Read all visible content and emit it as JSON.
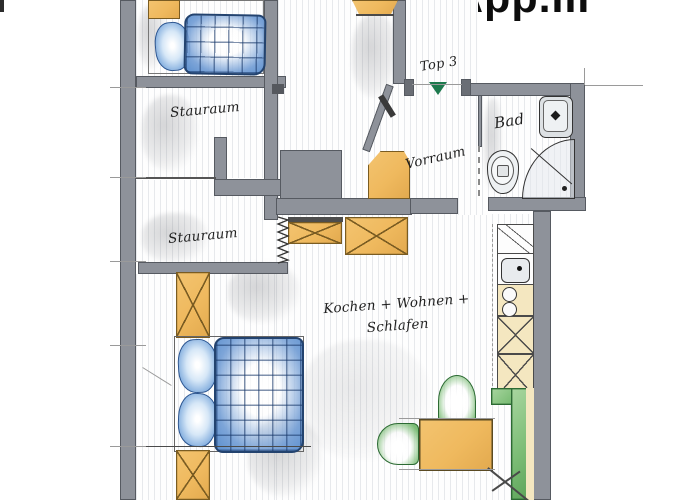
{
  "labels": {
    "title": "App.III",
    "entrance": "Top 3",
    "storage1": "Stauraum",
    "storage2": "Stauraum",
    "hallway": "Vorraum",
    "bathroom": "Bad",
    "living_line1": "Kochen + Wohnen +",
    "living_line2": "Schlafen"
  },
  "colors": {
    "wall": "#8e929a",
    "wall_edge": "#565a61",
    "furniture_orange": "#efb95e",
    "orange_edge": "#7a5c22",
    "bedding_blue": "#5b8fce",
    "bedding_blue_dark": "#23436f",
    "bedding_blue_light": "#d6e7f7",
    "furniture_green": "#7cbd76",
    "green_edge": "#2c6a33",
    "entrance_green": "#1e7a4e",
    "kitchen_cream": "#f4e7c0",
    "ink": "#1f1f1f",
    "pencil": "#9a9a9a"
  }
}
